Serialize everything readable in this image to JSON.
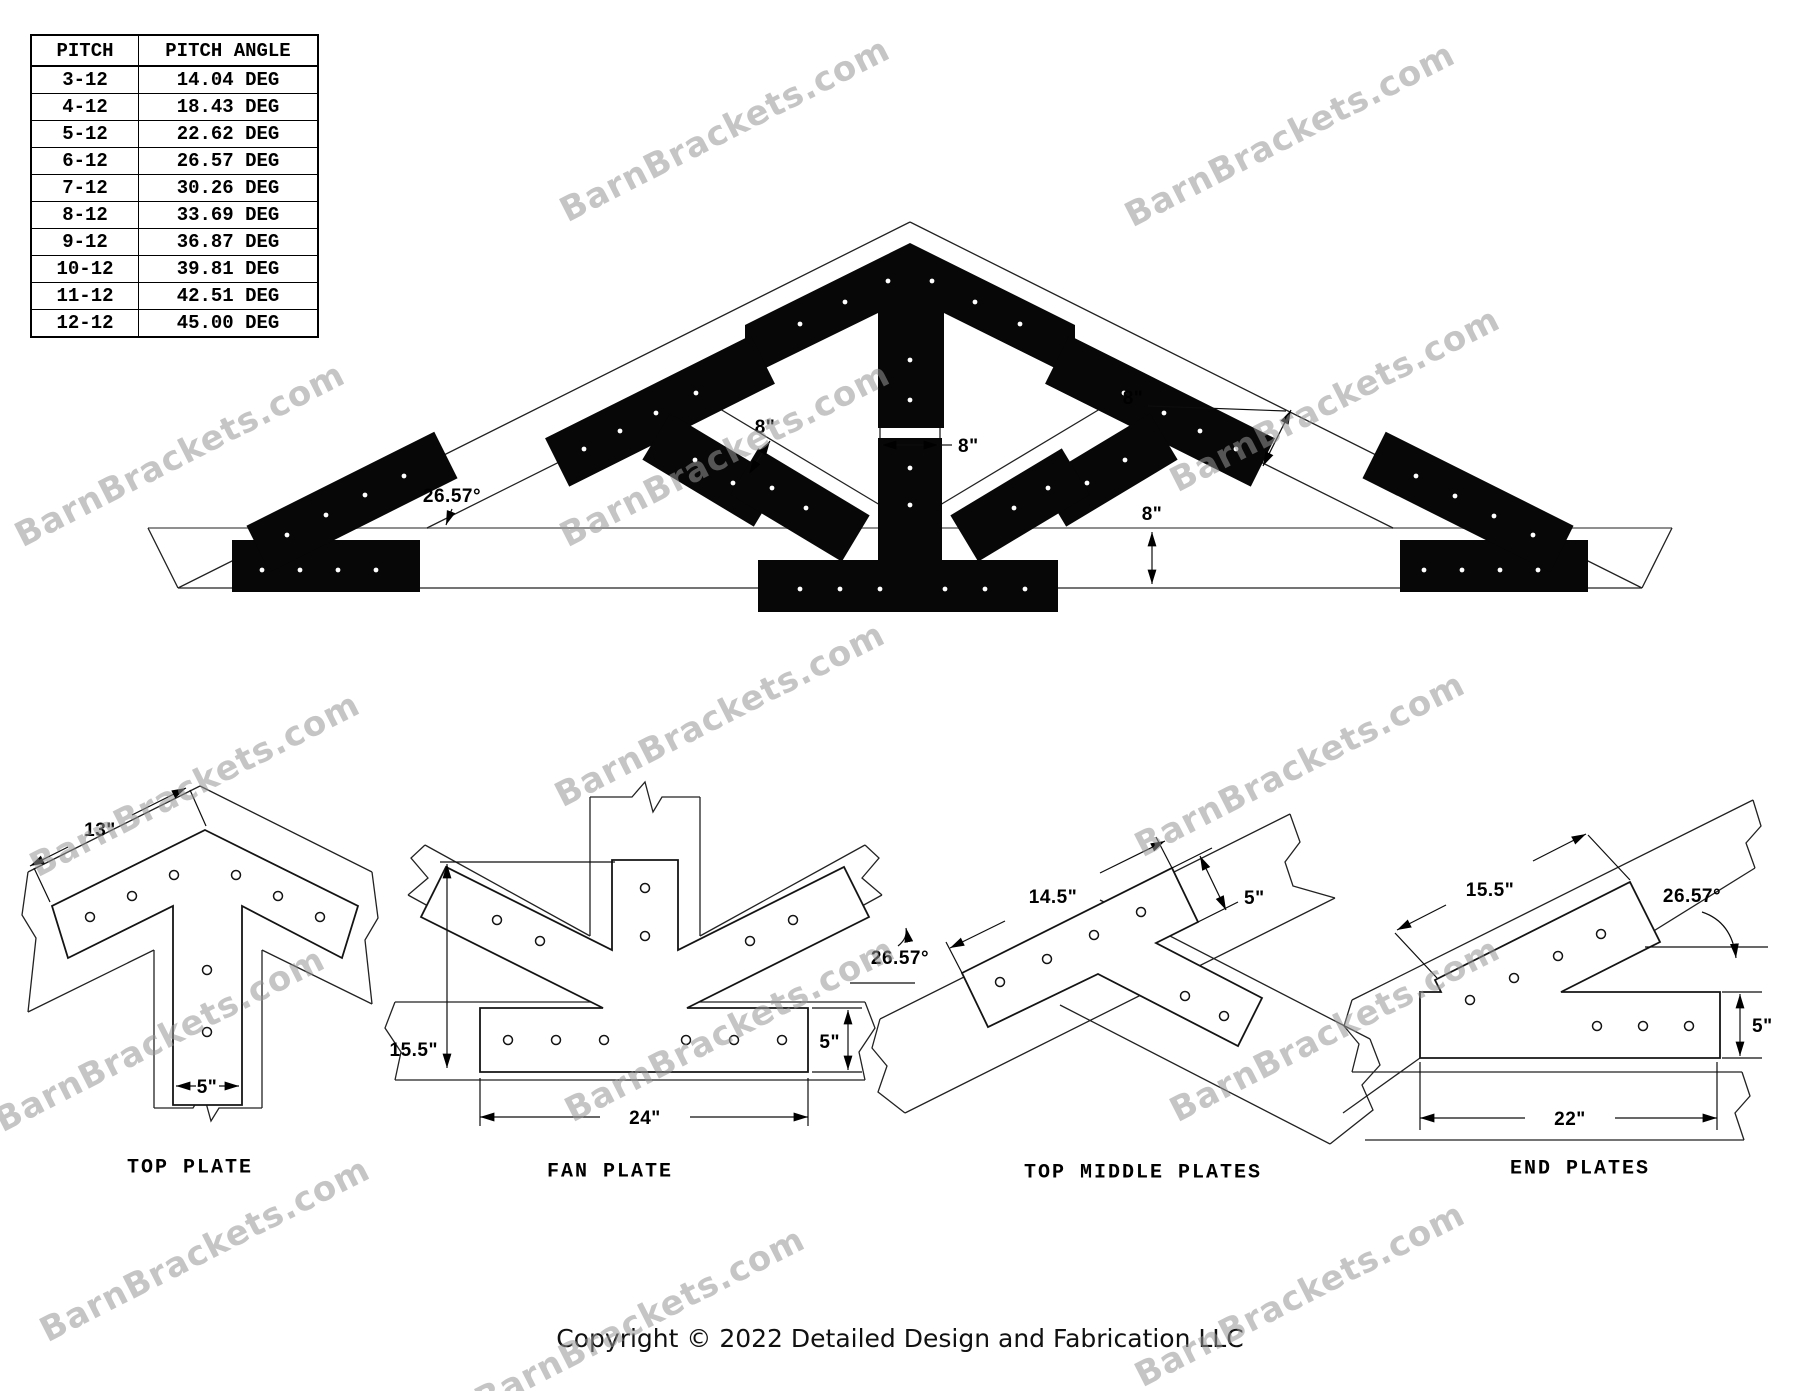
{
  "watermark": {
    "text": "BarnBrackets.com",
    "color": "#c9c9c9"
  },
  "pitch_table": {
    "headers": [
      "PITCH",
      "PITCH ANGLE"
    ],
    "rows": [
      [
        "3-12",
        "14.04 DEG"
      ],
      [
        "4-12",
        "18.43 DEG"
      ],
      [
        "5-12",
        "22.62 DEG"
      ],
      [
        "6-12",
        "26.57 DEG"
      ],
      [
        "7-12",
        "30.26 DEG"
      ],
      [
        "8-12",
        "33.69 DEG"
      ],
      [
        "9-12",
        "36.87 DEG"
      ],
      [
        "10-12",
        "39.81 DEG"
      ],
      [
        "11-12",
        "42.51 DEG"
      ],
      [
        "12-12",
        "45.00 DEG"
      ]
    ]
  },
  "truss": {
    "angle": "26.57°",
    "dim_width": "8\""
  },
  "details": {
    "top_plate": {
      "label": "TOP PLATE",
      "dim_arm": "13\"",
      "dim_leg": "5\""
    },
    "fan_plate": {
      "label": "FAN PLATE",
      "dim_height": "15.5\"",
      "dim_angle": "26.57°",
      "dim_base_height": "5\"",
      "dim_base_width": "24\""
    },
    "top_middle": {
      "label": "TOP MIDDLE PLATES",
      "dim_length": "14.5\"",
      "dim_width": "5\""
    },
    "end_plates": {
      "label": "END PLATES",
      "dim_arm": "15.5\"",
      "dim_angle": "26.57°",
      "dim_height": "5\"",
      "dim_length": "22\""
    }
  },
  "footer": {
    "copyright": "Copyright © 2022 Detailed Design and Fabrication LLC"
  }
}
